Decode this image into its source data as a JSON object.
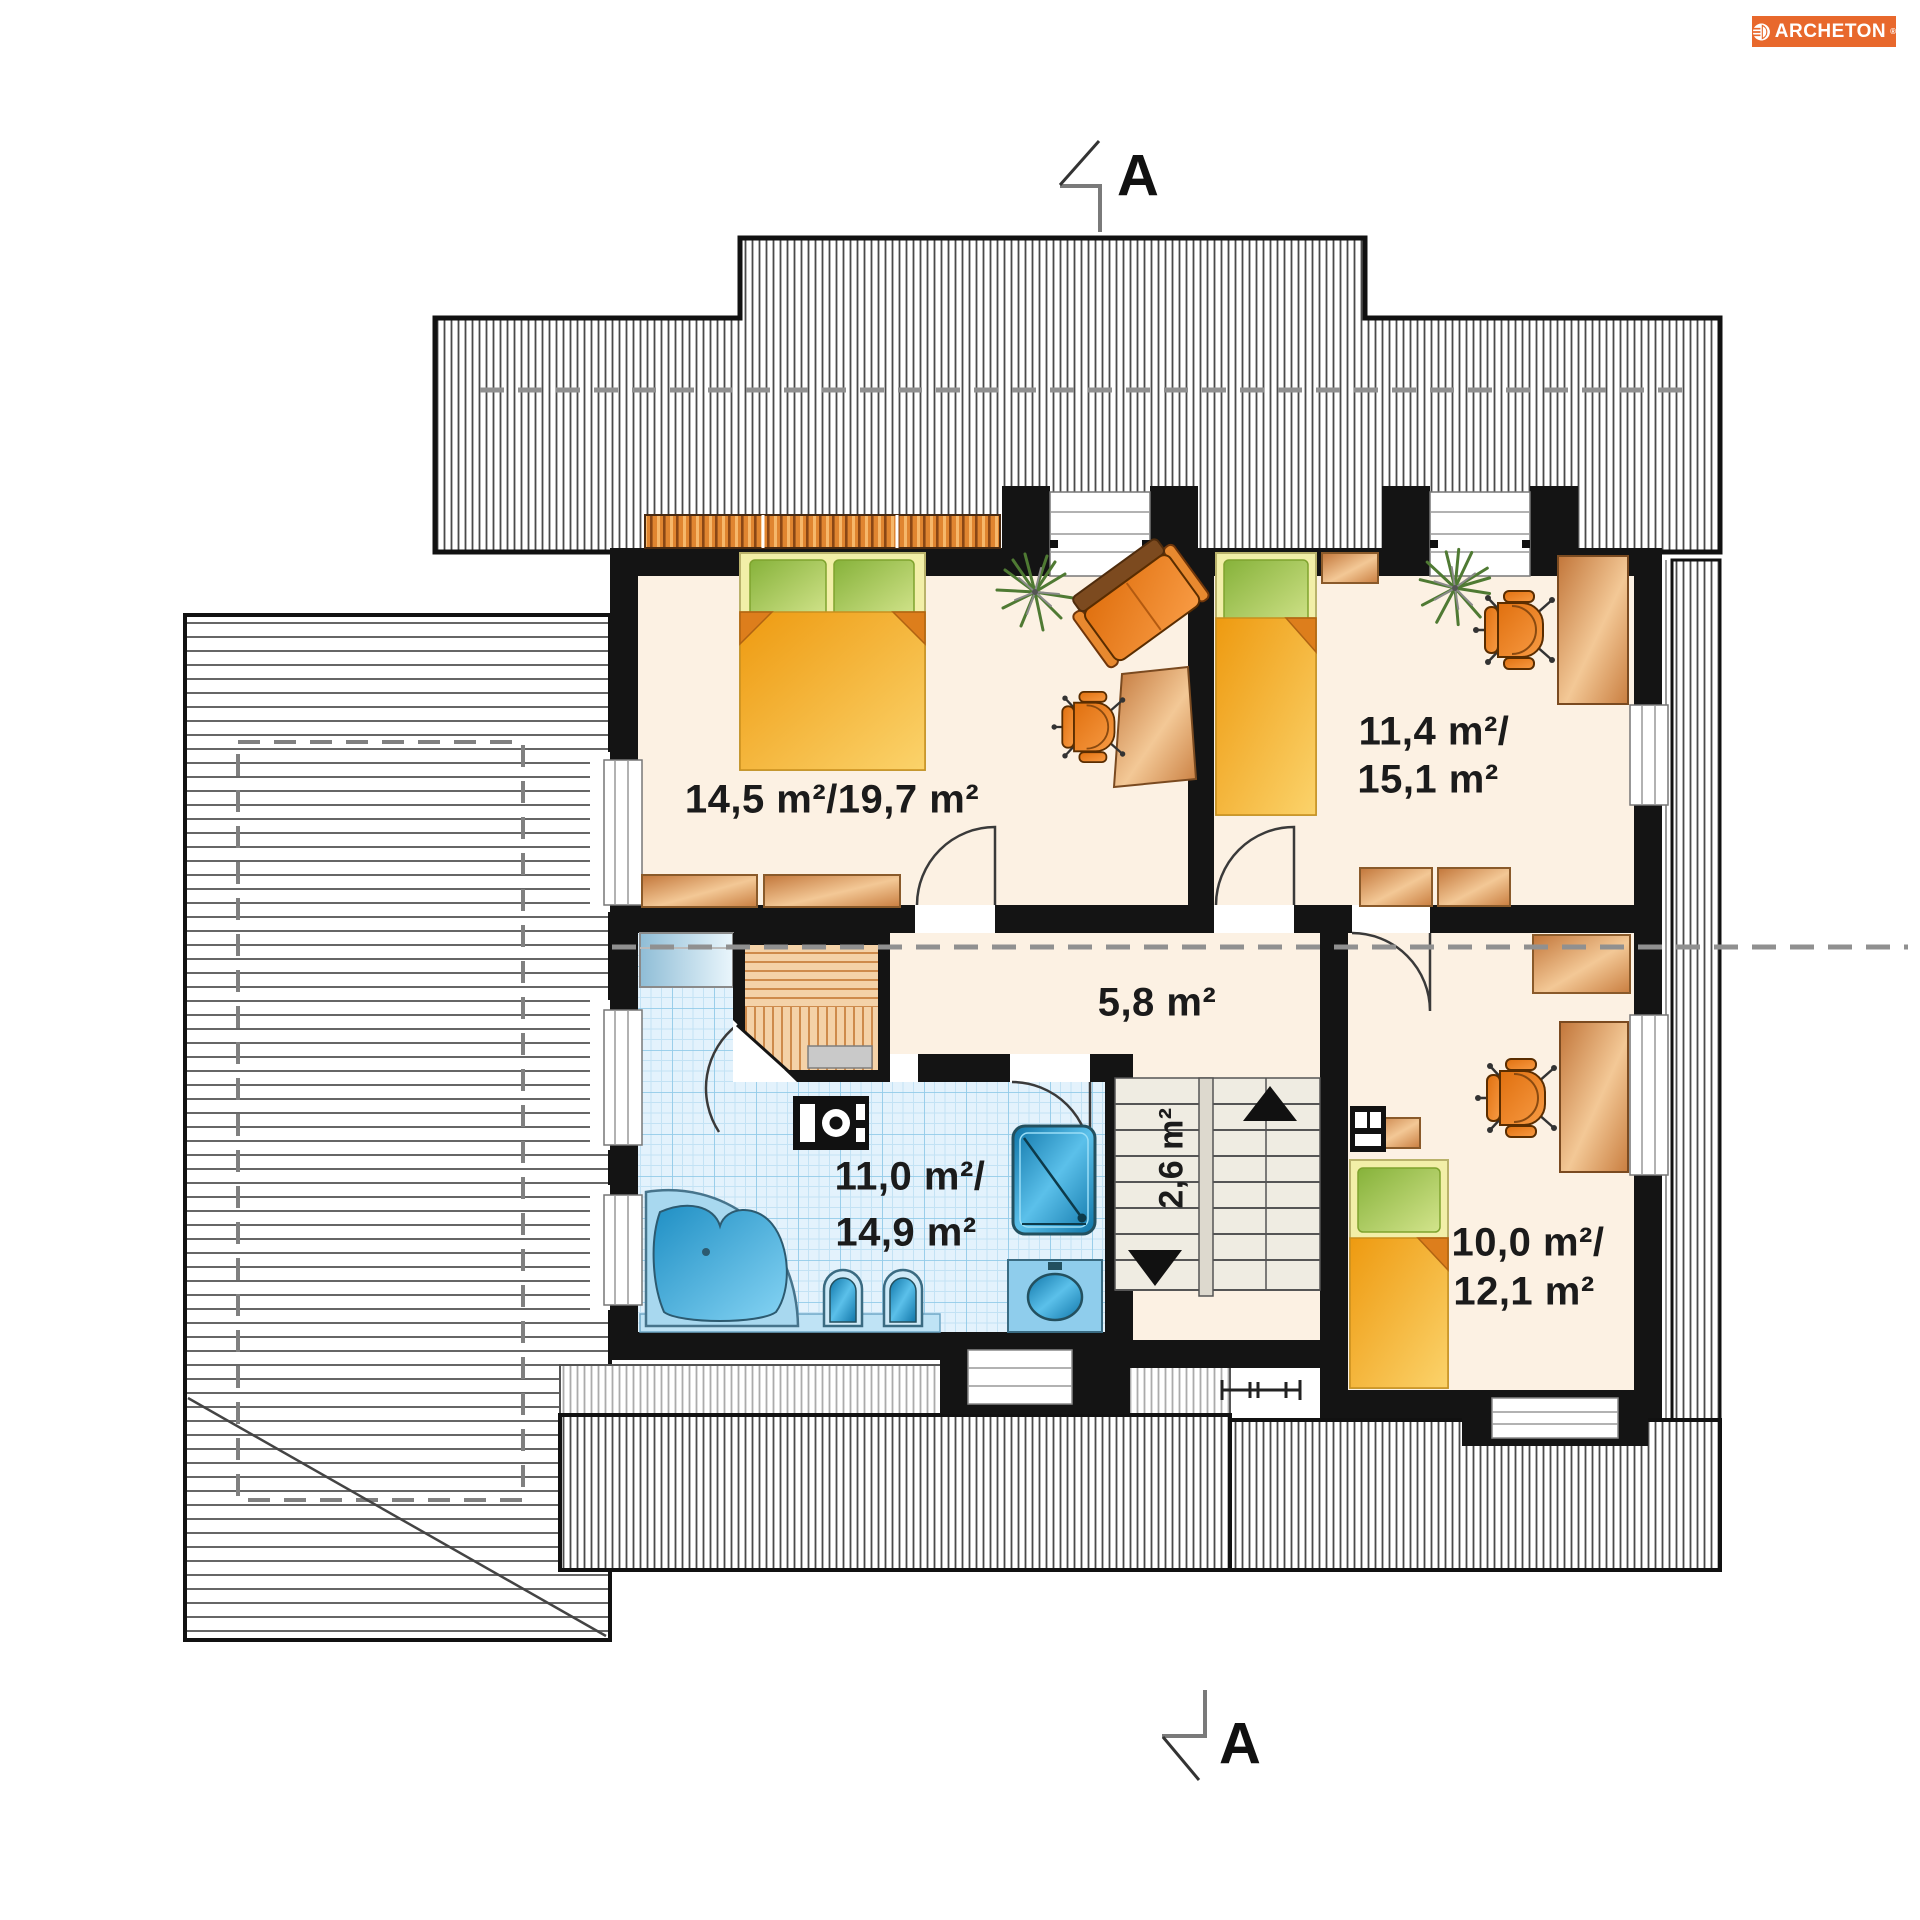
{
  "brand": {
    "name": "ARCHETON",
    "reg": "®",
    "bg_color": "#E8682C",
    "text_color": "#FFFFFF",
    "logo_icon": "archeton-mark-icon"
  },
  "section_markers": {
    "top_label": "A",
    "bottom_label": "A"
  },
  "plan": {
    "type": "attic floor plan",
    "rooms": [
      {
        "id": "bedroom-main",
        "area_label": "14,5 m²/19,7 m²",
        "floor_color": "#FCF1E3"
      },
      {
        "id": "bedroom-upper-right",
        "area_label_line1": "11,4 m²/",
        "area_label_line2": "15,1 m²",
        "floor_color": "#FCF1E3"
      },
      {
        "id": "hall",
        "area_label": "5,8 m²",
        "floor_color": "#FCF1E3"
      },
      {
        "id": "staircase",
        "area_label": "2,6 m²",
        "floor_color": "#EFECE2"
      },
      {
        "id": "bathroom",
        "area_label_line1": "11,0 m²/",
        "area_label_line2": "14,9 m²",
        "floor_color": "#DFF1FB"
      },
      {
        "id": "bedroom-lower-right",
        "area_label_line1": "10,0 m²/",
        "area_label_line2": "12,1 m²",
        "floor_color": "#FCF1E3"
      }
    ],
    "furniture_icons": [
      "double-bed-icon",
      "single-bed-icon",
      "wardrobe-icon",
      "cabinet-icon",
      "desk-icon",
      "office-chair-icon",
      "armchair-icon",
      "plant-icon",
      "sauna-icon",
      "sauna-heater-icon",
      "corner-bathtub-icon",
      "shower-icon",
      "toilet-icon",
      "bidet-icon",
      "washbasin-icon",
      "stairs-icon",
      "stairs-up-arrow-icon",
      "stairs-down-arrow-icon",
      "roof-vent-icon",
      "roof-window-icon"
    ],
    "colors": {
      "wall": "#141414",
      "roof_hatch": "#4a4a4a",
      "roof_hatch_light": "#ABABAB",
      "floor_cream": "#FCF1E3",
      "tile_blue": "#E3F2FC",
      "tile_grid": "#92CBE9",
      "furniture_orange": "#E87818",
      "wood_tan": "#D98F4C",
      "bed_yellow": "#F3A61F",
      "pillow_green": "#9CBD3F",
      "water_blue": "#2E9FD4",
      "dashed_line": "#909090"
    }
  }
}
